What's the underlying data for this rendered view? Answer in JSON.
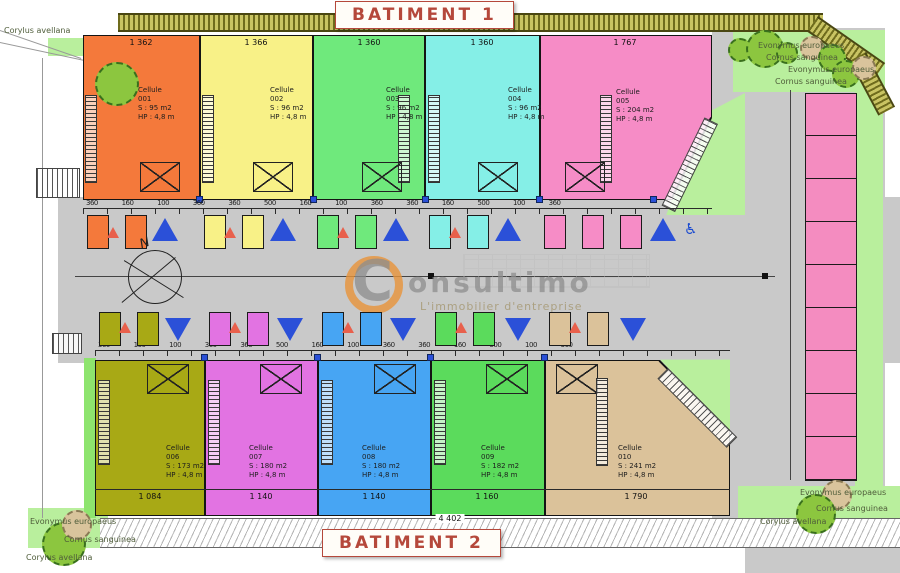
{
  "titles": {
    "batiment1": "BATIMENT 1",
    "batiment2": "BATIMENT 2"
  },
  "watermark": {
    "logo_letter": "C",
    "brand": "onsultimo",
    "tagline": "L'immobilier d'entreprise"
  },
  "compass": {
    "north": "N"
  },
  "labels": {
    "cell": "Cellule",
    "hp": "HP : 4,8 m"
  },
  "building1": {
    "cells": [
      {
        "num": "001",
        "area": "S : 95 m2",
        "dim": "1 362",
        "color": "#f4793b"
      },
      {
        "num": "002",
        "area": "S : 96 m2",
        "dim": "1 366",
        "color": "#f8f187"
      },
      {
        "num": "003",
        "area": "S : 96 m2",
        "dim": "1 360",
        "color": "#6fe97c"
      },
      {
        "num": "004",
        "area": "S : 96 m2",
        "dim": "1 360",
        "color": "#85efe7"
      },
      {
        "num": "005",
        "area": "S : 204 m2",
        "dim": "1 767",
        "color": "#f68cc6"
      }
    ]
  },
  "building2": {
    "cells": [
      {
        "num": "006",
        "area": "S : 173 m2",
        "dim": "1 084",
        "color": "#a8a915"
      },
      {
        "num": "007",
        "area": "S : 180 m2",
        "dim": "1 140",
        "color": "#e273e2"
      },
      {
        "num": "008",
        "area": "S : 180 m2",
        "dim": "1 140",
        "color": "#47a5f3"
      },
      {
        "num": "009",
        "area": "S : 182 m2",
        "dim": "1 160",
        "color": "#5bdb5c"
      },
      {
        "num": "010",
        "area": "S : 241 m2",
        "dim": "1 790",
        "color": "#dbc29a"
      }
    ]
  },
  "dims": {
    "total": "4 402",
    "micro_top": "360 160 100 360 360 500 160 100 360 360 160 500 100 360",
    "micro_bottom": "360 160 100 360 360 500 160 100 360 360 160 500 100 360"
  },
  "plants": {
    "corylus": "Corylus avellana",
    "evonymus": "Evonymus europaeus",
    "cornus": "Cornus sanguinea"
  },
  "icons": {
    "accessible": "♿"
  },
  "colors": {
    "arrow_blue": "#2b50d8",
    "arrow_red": "#e8604c",
    "road_gray": "#c9c9c9",
    "stall_pink": "#f48cc0",
    "hatch_olive": "#c9c463",
    "title_red": "#b5483b",
    "landscape_green": "#b9ef9d"
  }
}
